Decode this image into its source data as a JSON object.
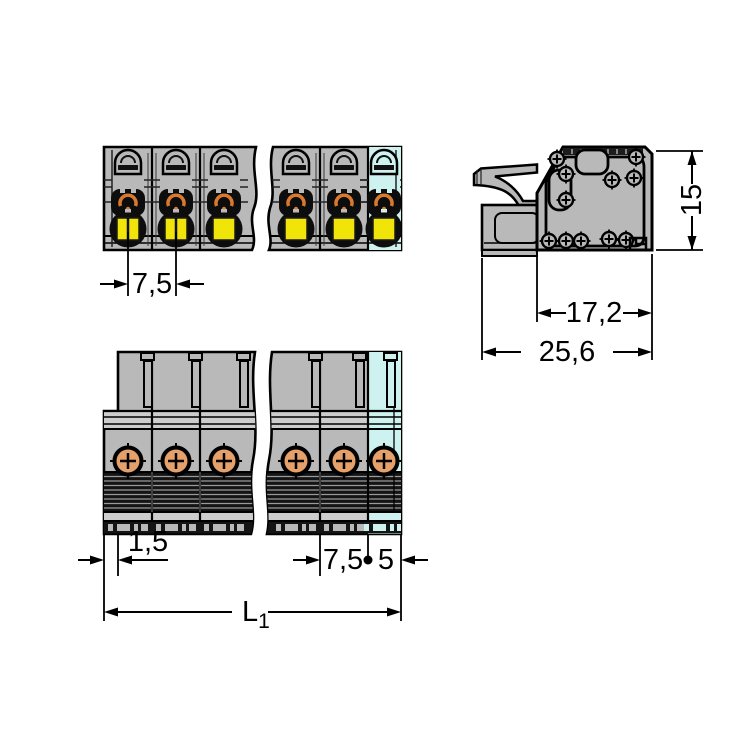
{
  "drawing": {
    "type": "technical-dimension-drawing",
    "subject": "multi-pole pluggable connector, front view, side view and top view with dimension annotations"
  },
  "dimensions": {
    "pole_pitch_front": "7,5",
    "height": "15",
    "depth_housing": "17,2",
    "depth_total": "25,6",
    "edge_offset": "1,5",
    "pole_pitch_bottom": "7,5",
    "end_clearance": "5",
    "total_length_symbol": "L",
    "total_length_subscript": "1"
  },
  "colors": {
    "body": "#b9b9b9",
    "light": "#cdcdcd",
    "outline": "#000000",
    "yellow": "#f0e408",
    "orange": "#d97a2e",
    "screw_orange": "#e5a169",
    "cyan": "#cdf2f0",
    "ribbed": "#141414"
  }
}
